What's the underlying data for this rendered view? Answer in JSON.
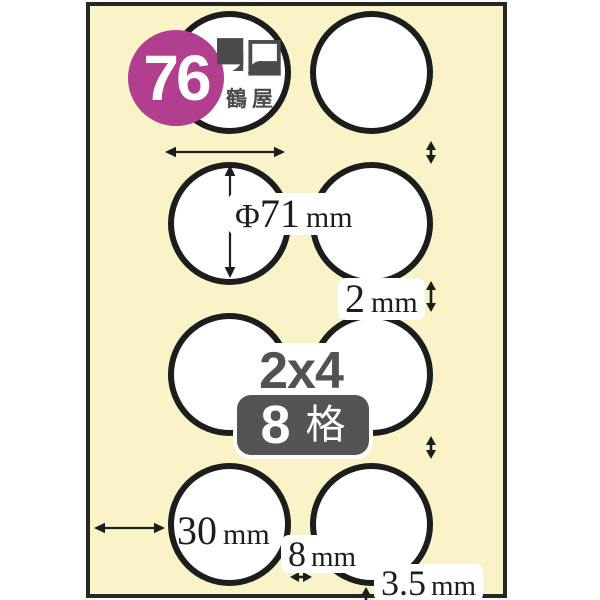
{
  "sheet": {
    "paper_color": "#faf3c8",
    "ink_color": "#1d1d1d"
  },
  "model_badge": {
    "number": "76",
    "color": "#b13e8e"
  },
  "brand": {
    "name": "鶴屋",
    "logo_icon": "overlapping-squares-icon",
    "color": "#4b4b4b"
  },
  "spec": {
    "grid_label": "2x4",
    "cell_count": "8",
    "cell_unit": "格",
    "accent_gray": "#545454"
  },
  "dimensions": {
    "diameter": {
      "prefix": "Φ",
      "value": "71",
      "unit": "mm"
    },
    "row_gap": {
      "value": "2",
      "unit": "mm"
    },
    "left_margin": {
      "value": "30",
      "unit": "mm"
    },
    "column_gap": {
      "value": "8",
      "unit": "mm"
    },
    "bottom_margin": {
      "value": "3.5",
      "unit": "mm"
    }
  },
  "icons": {
    "measure_arrow": "double-headed-arrow"
  }
}
